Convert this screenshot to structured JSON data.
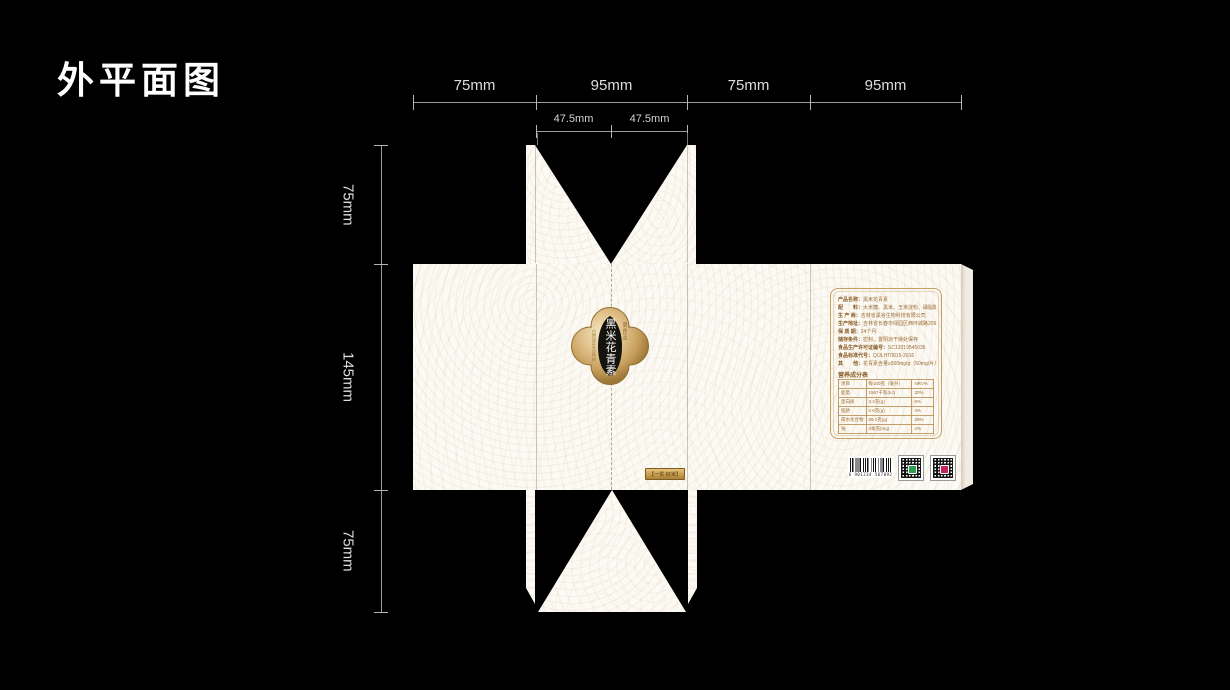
{
  "title": "外平面图",
  "dims": {
    "top": [
      "75mm",
      "95mm",
      "75mm",
      "95mm"
    ],
    "sub": [
      "47.5mm",
      "47.5mm"
    ],
    "left": [
      "75mm",
      "145mm",
      "75mm"
    ]
  },
  "emblem": {
    "brand": "黑米花青素",
    "seal": "御品珍选",
    "side": "自然原生态种植"
  },
  "badge": "【一贯·好米】",
  "info": {
    "lines": [
      {
        "label": "产品名称：",
        "value": "黑米花青素"
      },
      {
        "label": "配　　料：",
        "value": "大米糖、黑米、玉米淀粉、磷脂酸酯"
      },
      {
        "label": "生 产 商：",
        "value": "吉林省黑谷生物科技有限公司"
      },
      {
        "label": "生产地址：",
        "value": "吉林省长春市绿园区西环城路209号"
      },
      {
        "label": "保 质 期：",
        "value": "24个月"
      },
      {
        "label": "储存条件：",
        "value": "密封、置阴凉干燥处保存"
      },
      {
        "label": "食品生产许可证编号：",
        "value": "SC12019545035"
      },
      {
        "label": "食品标准代号：",
        "value": "Q/JLHT0015-2016"
      },
      {
        "label": "其　　他：",
        "value": "花青素含量≥500mg/g（50mg/片）"
      }
    ],
    "nutrition": {
      "title": "营养成分表",
      "headers": [
        "项目",
        "每100克（毫升）",
        "NRV%"
      ],
      "rows": [
        [
          "能量",
          "1567千焦(kJ)",
          "20%"
        ],
        [
          "蛋白质",
          "3.2克(g)",
          "5%"
        ],
        [
          "脂肪",
          "2.6克(g)",
          "4%"
        ],
        [
          "碳水化合物",
          "89.2克(g)",
          "29%"
        ],
        [
          "钠",
          "4毫克(mg)",
          "2%"
        ]
      ]
    }
  },
  "barcode": {
    "digits": "6 901234 567892"
  },
  "colors": {
    "background": "#000000",
    "paper": "#fcfaf5",
    "gold": "#c9a25e",
    "info_text": "#9b6c33",
    "qr1_accent": "#2b9e4f",
    "qr2_accent": "#c2255c"
  }
}
